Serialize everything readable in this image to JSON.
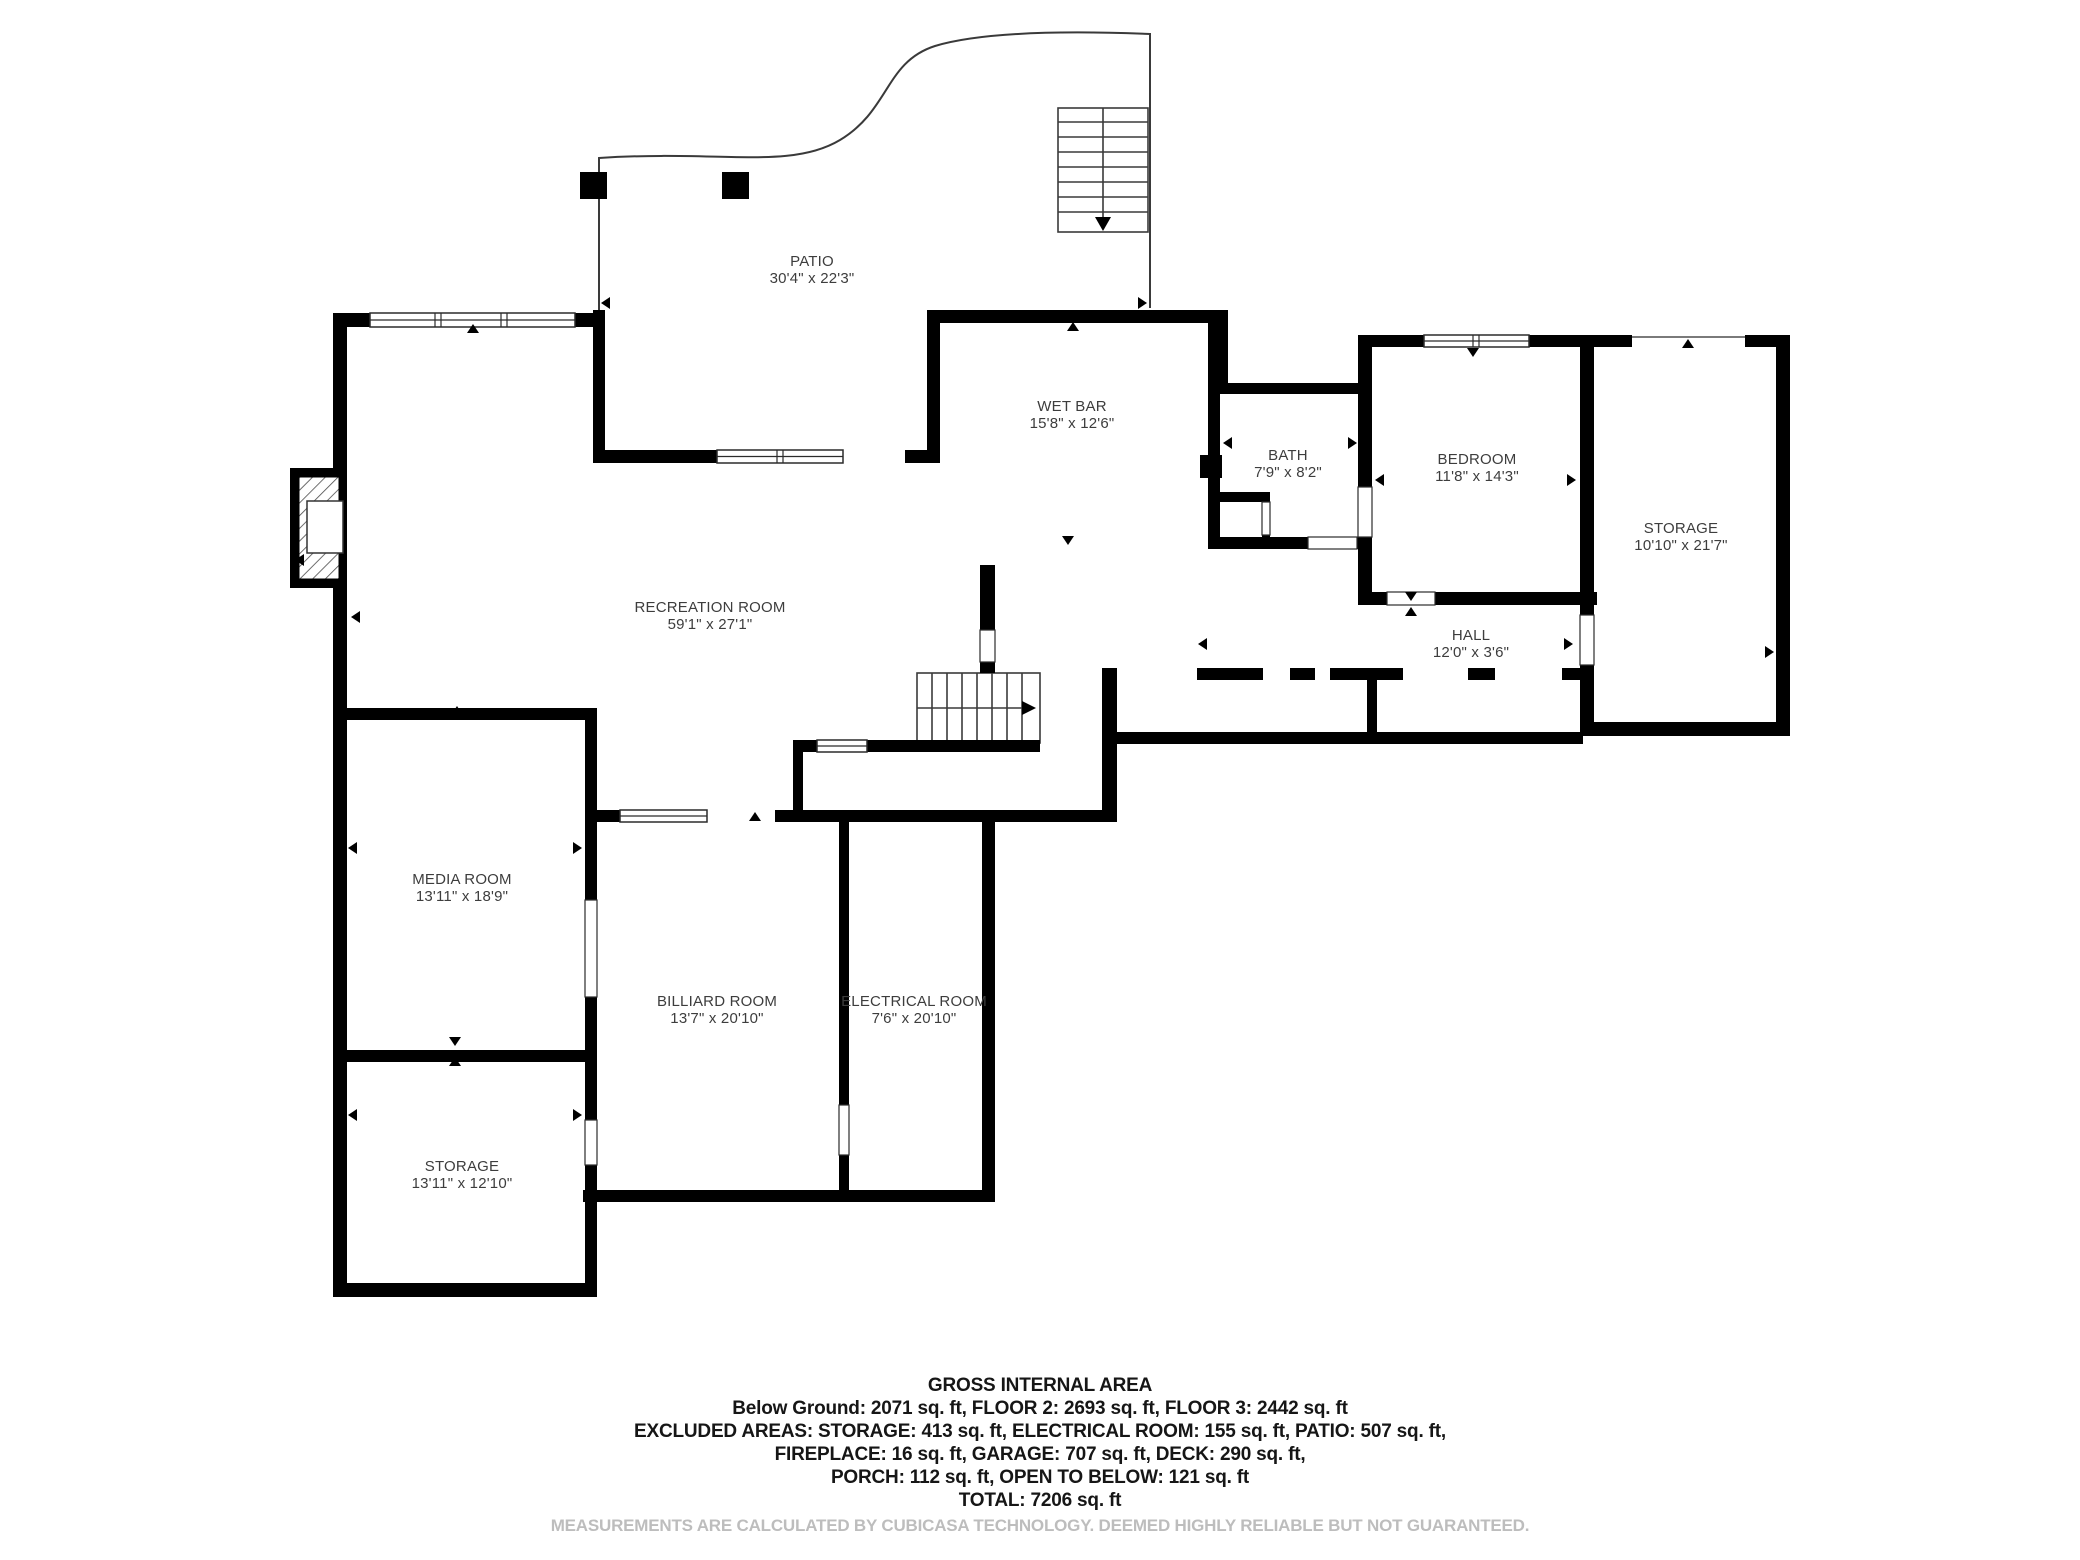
{
  "rooms": [
    {
      "name": "PATIO",
      "dims": "30'4\" x 22'3\""
    },
    {
      "name": "WET BAR",
      "dims": "15'8\" x 12'6\""
    },
    {
      "name": "BATH",
      "dims": "7'9\" x 8'2\""
    },
    {
      "name": "BEDROOM",
      "dims": "11'8\" x 14'3\""
    },
    {
      "name": "STORAGE",
      "dims": "10'10\" x 21'7\""
    },
    {
      "name": "HALL",
      "dims": "12'0\" x 3'6\""
    },
    {
      "name": "RECREATION ROOM",
      "dims": "59'1\" x 27'1\""
    },
    {
      "name": "MEDIA ROOM",
      "dims": "13'11\" x 18'9\""
    },
    {
      "name": "BILLIARD ROOM",
      "dims": "13'7\" x 20'10\""
    },
    {
      "name": "ELECTRICAL ROOM",
      "dims": "7'6\" x 20'10\""
    },
    {
      "name": "STORAGE",
      "dims": "13'11\" x 12'10\""
    }
  ],
  "footer": {
    "title": "GROSS INTERNAL AREA",
    "line1": "Below Ground: 2071 sq. ft, FLOOR 2: 2693 sq. ft, FLOOR 3: 2442 sq. ft",
    "line2": "EXCLUDED AREAS: STORAGE: 413 sq. ft, ELECTRICAL ROOM: 155 sq. ft, PATIO: 507 sq. ft,",
    "line3": "FIREPLACE: 16 sq. ft, GARAGE: 707 sq. ft, DECK: 290 sq. ft,",
    "line4": "PORCH: 112 sq. ft, OPEN TO BELOW: 121 sq. ft",
    "line5": "TOTAL: 7206 sq. ft",
    "disclaimer": "MEASUREMENTS ARE CALCULATED BY CUBICASA TECHNOLOGY. DEEMED HIGHLY RELIABLE BUT NOT GUARANTEED."
  },
  "colors": {
    "wall": "#000000",
    "thin_line": "#3a3a3a",
    "label_text": "#3d3d3d",
    "footer_text": "#161616",
    "disclaimer_text": "#bdbdbd",
    "background": "#ffffff"
  }
}
